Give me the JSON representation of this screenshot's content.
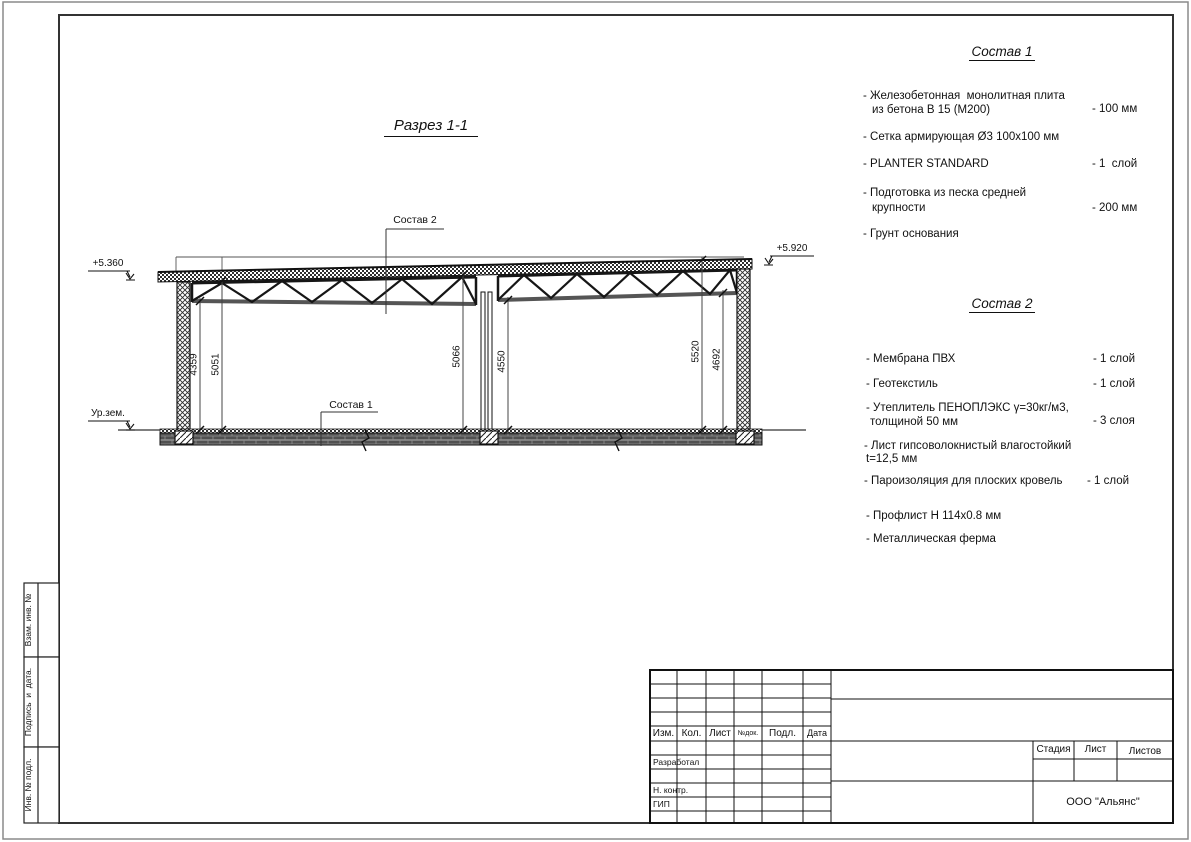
{
  "drawing": {
    "title": "Разрез 1-1"
  },
  "elevations": {
    "left": "+5.360",
    "right": "+5.920",
    "ground": "Ур.зем."
  },
  "callouts": {
    "roof": "Состав 2",
    "floor": "Состав 1"
  },
  "dimensions": {
    "left_inner": "4359",
    "left_outer": "5051",
    "mid_left": "5066",
    "mid_right": "4550",
    "right_outer": "5520",
    "right_inner": "4692"
  },
  "sostav1": {
    "title": "Состав 1",
    "items": [
      {
        "line1": "- Железобетонная  монолитная плита",
        "line2": "из бетона В 15 (М200)",
        "value": "- 100 мм"
      },
      {
        "line1": "- Сетка армирующая Ø3 100х100 мм",
        "line2": "",
        "value": ""
      },
      {
        "line1": "- PLANTER STANDARD",
        "line2": "",
        "value": "- 1  слой"
      },
      {
        "line1": "- Подготовка из песка средней",
        "line2": "крупности",
        "value": "- 200 мм"
      },
      {
        "line1": "- Грунт основания",
        "line2": "",
        "value": ""
      }
    ]
  },
  "sostav2": {
    "title": "Состав 2",
    "items": [
      {
        "line1": "- Мембрана ПВХ",
        "line2": "",
        "value": "- 1 слой"
      },
      {
        "line1": "- Геотекстиль",
        "line2": "",
        "value": "- 1 слой"
      },
      {
        "line1": "- Утеплитель ПЕНОПЛЭКС γ=30кг/м3,",
        "line2": "толщиной 50 мм",
        "value": "- 3 слоя"
      },
      {
        "line1": "- Лист гипсоволокнистый влагостойкий",
        "line2": "t=12,5 мм",
        "value": ""
      },
      {
        "line1": "- Пароизоляция для плоских кровель",
        "line2": "",
        "value": "- 1 слой"
      },
      {
        "line1": "- Профлист Н 114х0.8 мм",
        "line2": "",
        "value": ""
      },
      {
        "line1": "- Металлическая ферма",
        "line2": "",
        "value": ""
      }
    ]
  },
  "titleblock": {
    "headers": {
      "izm": "Изм.",
      "kol": "Кол.",
      "list": "Лист",
      "ndok": "№док.",
      "podl": "Подл.",
      "data": "Дата"
    },
    "roles": {
      "razrabotal": "Разработал",
      "nkontr": "Н. контр.",
      "gip": "ГИП"
    },
    "stage": {
      "stadia": "Стадия",
      "list": "Лист",
      "listov": "Листов"
    },
    "company": "ООО \"Альянс\""
  },
  "side_strip": {
    "vzam": "Взам. инв. №",
    "podpis": "Подпись  и  дата.",
    "inv": "Инв. № подл."
  }
}
